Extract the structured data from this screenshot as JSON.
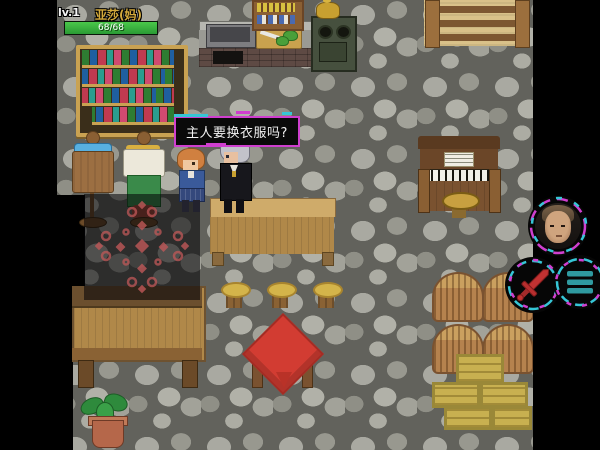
{
  "hud": {
    "level": "lv.1",
    "name": "亚莎(妈)",
    "hp_text": "68/68",
    "hp_current": 68,
    "hp_max": 68,
    "hp_color": "#3cb24a",
    "name_color": "#d4aa3c"
  },
  "dialogue": {
    "text": "主人要换衣服吗?",
    "background": "#0a0a0a",
    "border_color": "#cf3fcf",
    "accent_color": "#36c6d6",
    "text_color": "#f2f2f2"
  },
  "controls": {
    "avatar_button": {
      "icon": "player-portrait",
      "ring_colors": [
        "#cf3fcf",
        "#36c6d6"
      ]
    },
    "attack_button": {
      "icon": "sword-icon",
      "icon_color": "#bb2f2f"
    },
    "menu_button": {
      "icon": "menu-lines-icon",
      "icon_color": "#2f9aa0"
    }
  },
  "scene": {
    "floor": "gray cobblestone tiles",
    "objects": [
      "bookshelf with colored books",
      "kitchen counter with sink",
      "cutting board with knife and greens",
      "wall shelf with bottles and jars",
      "green stove with gold kettle",
      "wooden staircase",
      "mannequin with brown tunic and blue scarf",
      "mannequin with white shirt and green pants",
      "maid NPC with orange hair",
      "butler NPC with silver hair",
      "long wooden table",
      "dark rug with red ornament",
      "wooden bed",
      "three gold stools",
      "small table with red cloth",
      "upright piano with sheet music",
      "piano stool",
      "four firewood piles",
      "stacked wooden crates",
      "potted plant"
    ]
  }
}
